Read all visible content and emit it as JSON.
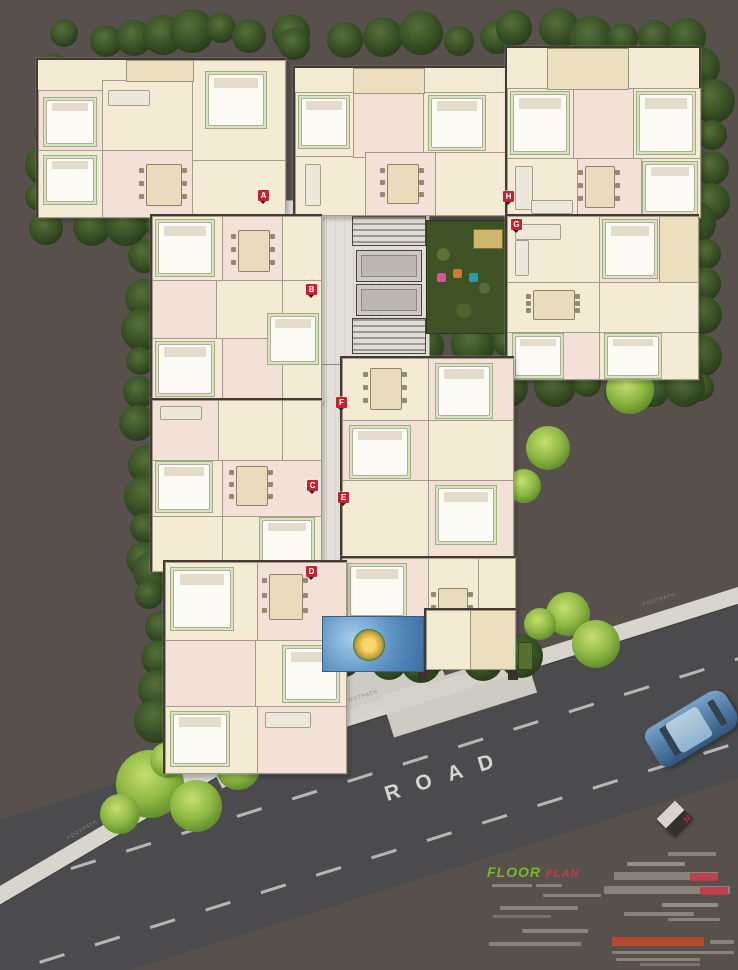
{
  "scene": {
    "road_label": "ROAD",
    "footpath_label": "FOOTPATH",
    "caption": {
      "floor_text": "FLOOR",
      "plan_text": "PLAN"
    },
    "compass_north": "N",
    "markers": [
      {
        "label": "A",
        "x": 263,
        "y": 195
      },
      {
        "label": "B",
        "x": 311,
        "y": 289
      },
      {
        "label": "C",
        "x": 312,
        "y": 485
      },
      {
        "label": "D",
        "x": 311,
        "y": 571
      },
      {
        "label": "E",
        "x": 343,
        "y": 497
      },
      {
        "label": "F",
        "x": 341,
        "y": 402
      },
      {
        "label": "G",
        "x": 516,
        "y": 224
      },
      {
        "label": "H",
        "x": 508,
        "y": 196
      }
    ],
    "colors": {
      "background": "#57504d",
      "road": "#4b4b4d",
      "footpath": "#d8d5cf",
      "building_floor": "#f2ead2",
      "wall": "#433b32",
      "tree_dark": "#3a5226",
      "tree_light": "#8fb844",
      "water": "#5e93c4",
      "marker_red": "#c8202c",
      "caption_green": "#76b82a",
      "caption_red": "#c23b47",
      "car_blue": "#5580ab",
      "courtyard_green": "#3f5226"
    }
  }
}
